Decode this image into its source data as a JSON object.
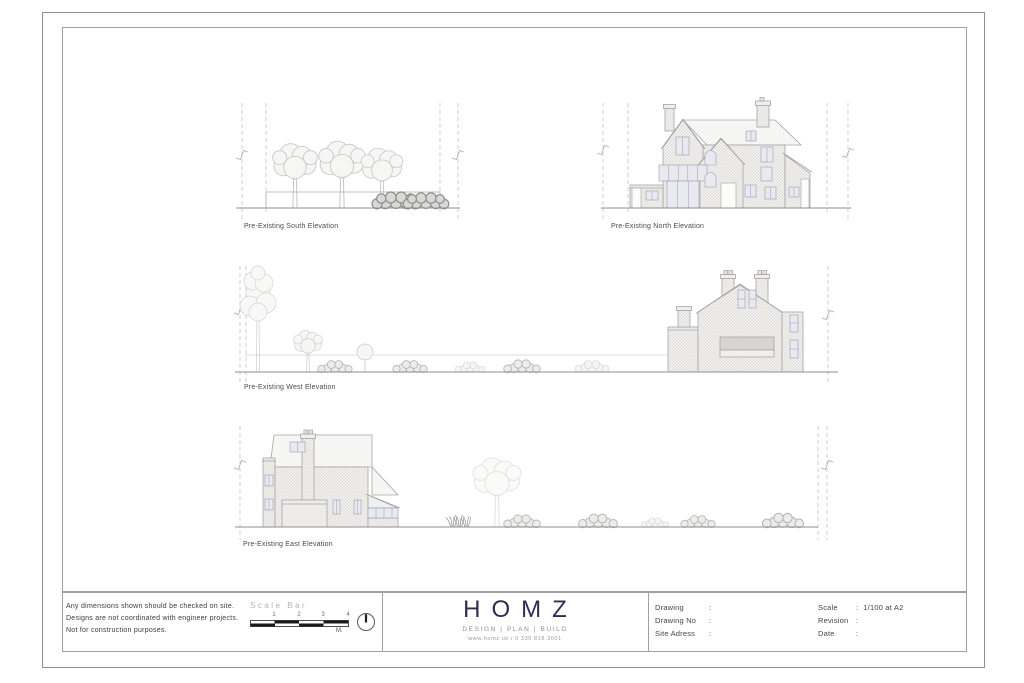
{
  "sheet": {
    "elevations": [
      {
        "label": "Pre-Existing South Elevation"
      },
      {
        "label": "Pre-Existing North Elevation"
      },
      {
        "label": "Pre-Existing West Elevation"
      },
      {
        "label": "Pre-Existing East Elevation"
      }
    ]
  },
  "title_block": {
    "disclaimer": {
      "line1": "Any dimensions shown should be checked on site.",
      "line2": "Designs are not coordinated with engineer projects.",
      "line3": "Not for construction purposes."
    },
    "scale_bar": {
      "label": "Scale Bar",
      "ticks": [
        "1",
        "2",
        "3",
        "4"
      ],
      "unit": "M."
    },
    "brand": {
      "name": "HOMZ",
      "tagline": "DESIGN | PLAN | BUILD",
      "contact": "www.homz.uk / 0 330 818 3001",
      "color": "#312d52"
    },
    "info": {
      "colon": ":",
      "drawing_label": "Drawing",
      "drawing_value": "",
      "drawing_no_label": "Drawing No",
      "drawing_no_value": "",
      "site_address_label": "Site Adress",
      "site_address_value": "",
      "scale_label": "Scale",
      "scale_value": "1/100 at A2",
      "revision_label": "Revision",
      "revision_value": "",
      "date_label": "Date",
      "date_value": ""
    }
  }
}
